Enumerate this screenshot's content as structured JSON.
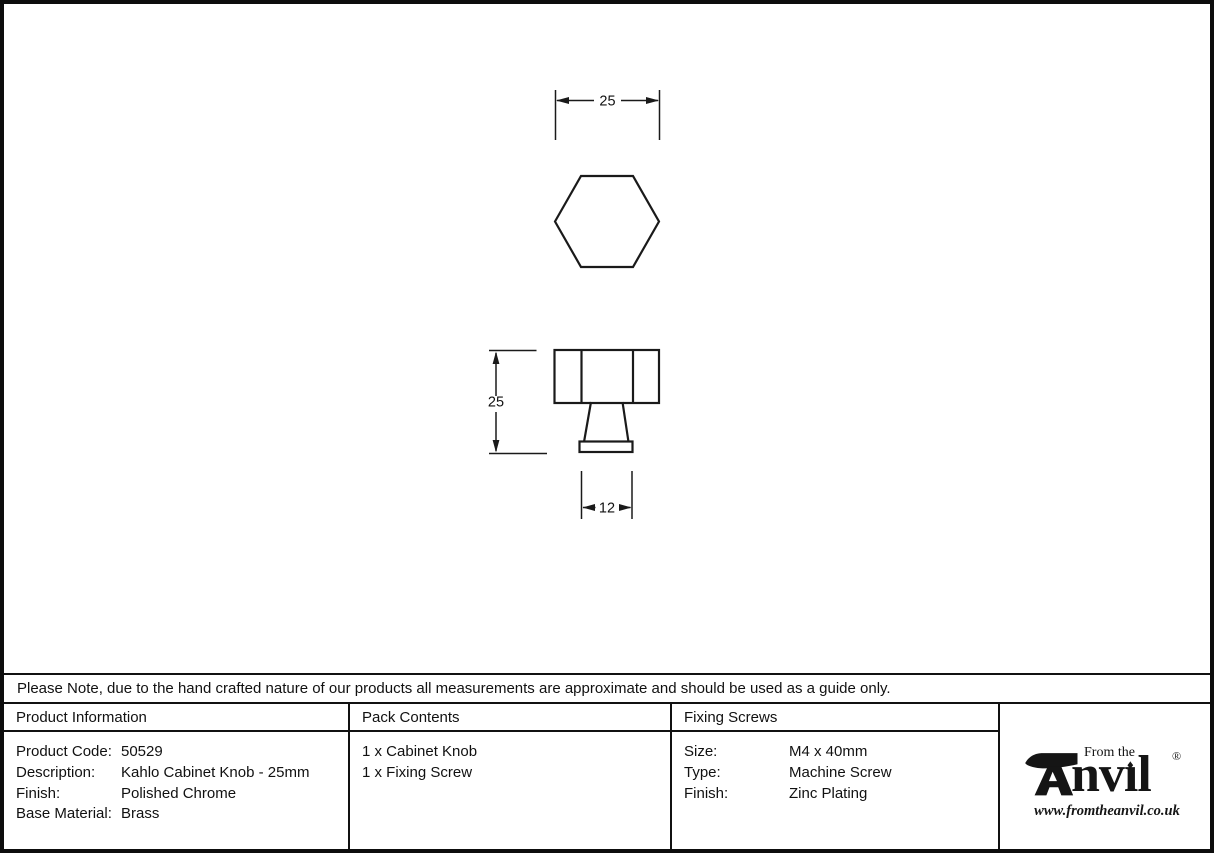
{
  "drawing": {
    "top_view_width_label": "25",
    "side_view_height_label": "25",
    "base_width_label": "12"
  },
  "note": {
    "text": "Please Note, due to the hand crafted nature of our products all measurements are approximate and should be used as a guide only."
  },
  "product_information": {
    "header": "Product Information",
    "rows": [
      {
        "label": "Product Code:",
        "value": "50529"
      },
      {
        "label": "Description:",
        "value": "Kahlo Cabinet Knob - 25mm"
      },
      {
        "label": "Finish:",
        "value": "Polished Chrome"
      },
      {
        "label": "Base Material:",
        "value": "Brass"
      }
    ]
  },
  "pack_contents": {
    "header": "Pack Contents",
    "items": [
      "1 x Cabinet Knob",
      "1 x Fixing Screw"
    ]
  },
  "fixing_screws": {
    "header": "Fixing Screws",
    "rows": [
      {
        "label": "Size:",
        "value": "M4 x 40mm"
      },
      {
        "label": "Type:",
        "value": "Machine Screw"
      },
      {
        "label": "Finish:",
        "value": "Zinc Plating"
      }
    ]
  },
  "logo": {
    "prefix_text": "From the",
    "brand_prefix": "nv",
    "brand_i": "ı",
    "brand_suffix": "l",
    "registered_mark": "®",
    "website": "www.fromtheanvil.co.uk"
  },
  "colors": {
    "line": "#1a1a1a",
    "background": "#ffffff"
  }
}
